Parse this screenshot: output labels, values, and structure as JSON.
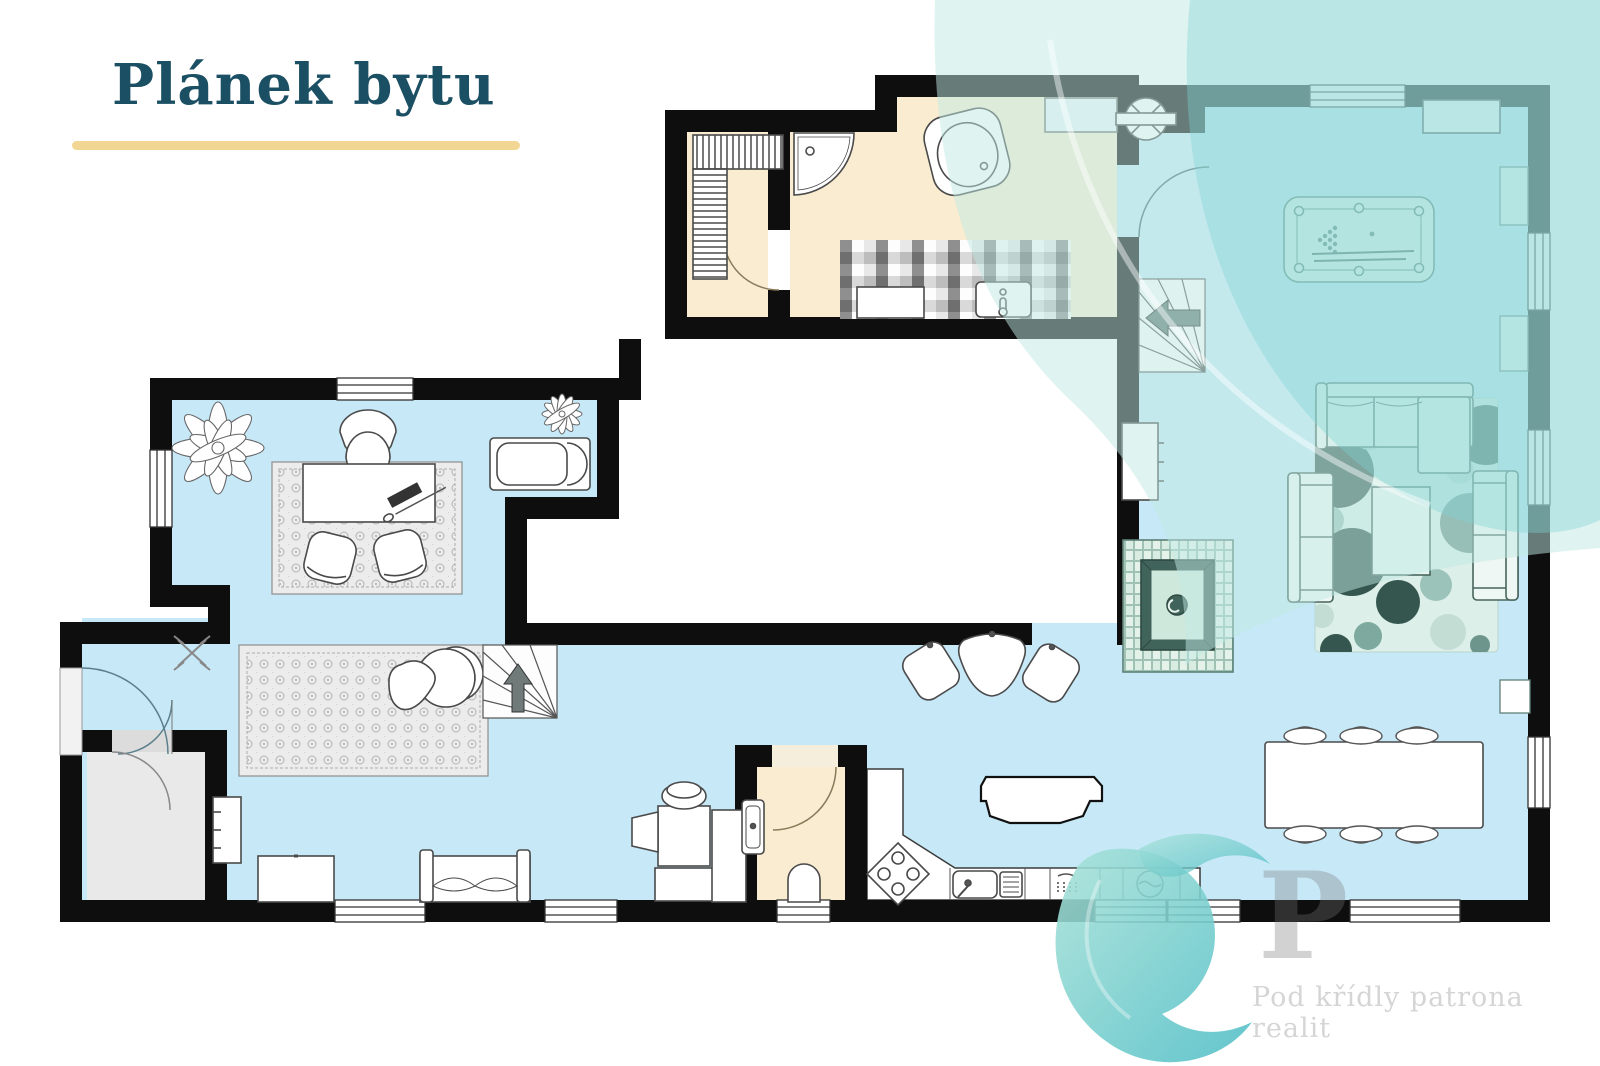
{
  "page": {
    "title": "Plánek bytu",
    "title_color": "#1b4f63",
    "underline_color": "#f2d694",
    "background": "#ffffff"
  },
  "watermark": {
    "text": "Pod křídly patrona realit",
    "letter": "P",
    "color": "#d5d5d5"
  },
  "brand": {
    "corner_swoosh": "teal-corner-swoosh",
    "logo": "teal-swirl-logo",
    "swoosh_mint": "#bfeae4",
    "swoosh_teal": "#7ed2d2",
    "logo_teal": "#4dbdc5"
  },
  "floorplan": {
    "wall_color": "#0e0e0e",
    "floor_colors": {
      "living_blue": "#c7e8f7",
      "wet_cream": "#f9ecd1",
      "storage_gray": "#e9e9e9",
      "outside_white": "#ffffff",
      "fireplace_green": "#40635a"
    },
    "rooms": [
      {
        "name": "sauna",
        "floor": "wet_cream"
      },
      {
        "name": "bathroom",
        "floor": "wet_cream"
      },
      {
        "name": "game-room",
        "floor": "living_blue"
      },
      {
        "name": "living-room",
        "floor": "living_blue"
      },
      {
        "name": "dining-area",
        "floor": "living_blue"
      },
      {
        "name": "kitchen",
        "floor": "outside_white"
      },
      {
        "name": "home-office",
        "floor": "living_blue"
      },
      {
        "name": "entry-hall",
        "floor": "living_blue"
      },
      {
        "name": "wc",
        "floor": "wet_cream"
      },
      {
        "name": "storage-room",
        "floor": "storage_gray"
      },
      {
        "name": "courtyard-void",
        "floor": "outside_white"
      }
    ],
    "furniture": [
      "sauna-benches",
      "corner-shower",
      "corner-bathtub",
      "mosaic-vanity",
      "vanity-stove",
      "vanity-sink",
      "bath-counter",
      "ceiling-fan",
      "winder-stairs",
      "pool-table",
      "top-cabinet",
      "wall-cabinets",
      "sectional-sofa",
      "loveseat-left",
      "loveseat-right",
      "coffee-table",
      "polka-dot-rug",
      "fireplace",
      "hall-cabinet",
      "dining-table",
      "dining-chairs",
      "desk",
      "office-chair",
      "guest-chairs",
      "office-rug",
      "large-plant",
      "small-plant",
      "daybed",
      "ornate-rug",
      "papasan-chair",
      "triangle-pouf",
      "pouf-group",
      "straight-stairs",
      "shelf-unit",
      "sideboard",
      "bench-sofa",
      "laundry-press",
      "wc-sink",
      "toilet",
      "kitchen-island",
      "corner-stove",
      "kitchen-sink",
      "dishwasher",
      "washing-machine",
      "drying-rack"
    ]
  }
}
